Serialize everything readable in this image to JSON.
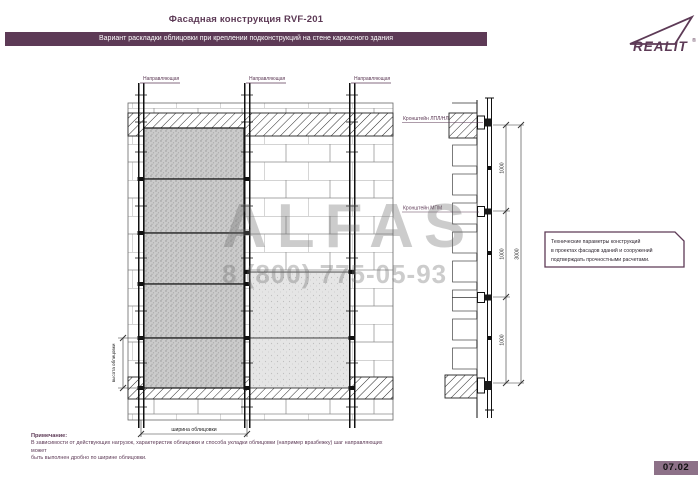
{
  "header": {
    "title": "Фасадная конструкция RVF-201",
    "banner": "Вариант раскладки облицовки при креплении подконструкций на стене каркасного здания",
    "logo_text": "REALIT",
    "logo_reg": "®"
  },
  "left_view": {
    "rail_label_1": "Направляющая",
    "rail_label_2": "Направляющая",
    "rail_label_3": "Направляющая",
    "width_dim_label": "ширина облицовки",
    "height_dim_label": "высота облицовки"
  },
  "section_view": {
    "bracket_top_label": "Кронштейн ЛПЛ/НЛ",
    "bracket_mid_label": "Кронштейн МПМ",
    "dim_1": "1000",
    "dim_2": "1000",
    "dim_3": "1000",
    "dim_total": "3000"
  },
  "note_box": {
    "line1": "Технические параметры конструкций",
    "line2": "в проектах фасадов зданий и сооружений",
    "line3": "подтверждать прочностными расчетами."
  },
  "footnote": {
    "heading": "Примечание:",
    "line1": "В зависимости от действующих нагрузок, характеристик облицовки и способа укладки облицовки (например вразбежку) шаг направляющих может",
    "line2": "быть выполнен дробно по ширине облицовки."
  },
  "footer": {
    "page_number": "07.02"
  },
  "watermark": {
    "name": "ALFAS",
    "phone": "8 (800) 775-05-93"
  },
  "colors": {
    "accent": "#5d3a56",
    "badge_bg": "#8d7188"
  }
}
